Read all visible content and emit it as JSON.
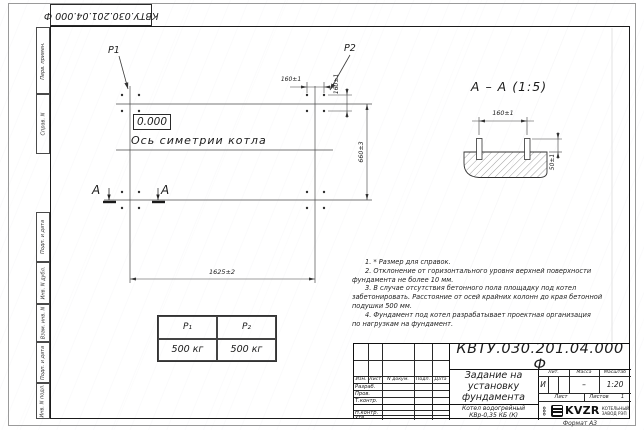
{
  "frame": {
    "format_note": "Формат А3"
  },
  "top_stamp": {
    "designation": "КВТУ.030.201.04.000  Ф"
  },
  "margin": {
    "items": [
      {
        "label": "Перв. примен."
      },
      {
        "label": "Справ. N"
      },
      {
        "label": "Подп. и дата"
      },
      {
        "label": "Инв. N дубл."
      },
      {
        "label": "Взам. инв. N"
      },
      {
        "label": "Подп. и дата"
      },
      {
        "label": "Инв. N подл."
      }
    ]
  },
  "drawing": {
    "p1": "Р1",
    "p2": "Р2",
    "elevation": "0.000",
    "axis_label": "Ось симетрии котла",
    "section_letter_left": "А",
    "section_letter_right": "А",
    "section_title": "А – А (1:5)",
    "dims": {
      "top_h": "160±1",
      "top_v": "160±1",
      "right_v": "660±3",
      "bottom_h": "1625±2",
      "section_h": "160±1",
      "section_v": "50±1"
    },
    "notes": [
      {
        "text": "1. * Размер для справок."
      },
      {
        "text": "2. Отклонение от горизонтального уровня верхней поверхности"
      },
      {
        "text": "фундамента не более 10 мм."
      },
      {
        "text": "3. В случае отсутствия бетонного пола площадку под котел"
      },
      {
        "text": "забетонировать. Расстояние от осей крайних колонн до края бетонной"
      },
      {
        "text": "подушки 500 мм."
      },
      {
        "text": "4. Фундамент под котел разрабатывает проектная организация"
      },
      {
        "text": "по нагрузкам на фундамент."
      }
    ],
    "load_table": {
      "headers": [
        "Р₁",
        "Р₂"
      ],
      "values": [
        "500 кг",
        "500 кг"
      ]
    }
  },
  "title_block": {
    "designation": "КВТУ.030.201.04.000  Ф",
    "doc_title_lines": [
      "Задание на",
      "установку",
      "фундамента"
    ],
    "product_lines": [
      "Котел водогрейный",
      "КВр-0,35 КБ (К)"
    ],
    "header_cols": [
      "Изм.",
      "Лист",
      "N докум.",
      "Подп.",
      "Дата"
    ],
    "row_labels": [
      "Разраб.",
      "Пров.",
      "Т.контр.",
      "Н.контр.",
      "Утв."
    ],
    "lit_label": "Лит.",
    "mass_label": "Масса",
    "scale_label": "Масштаб",
    "lit_value": "И",
    "mass_value": "–",
    "scale_value": "1:20",
    "sheet_label": "Лист",
    "sheets_label": "Листов",
    "sheets_value": "1",
    "logo_prefix": "ООО",
    "logo_text": "KVZR",
    "company_lines": [
      "КОТЕЛЬНЫЙ",
      "ЗАВОД РЭП"
    ]
  }
}
